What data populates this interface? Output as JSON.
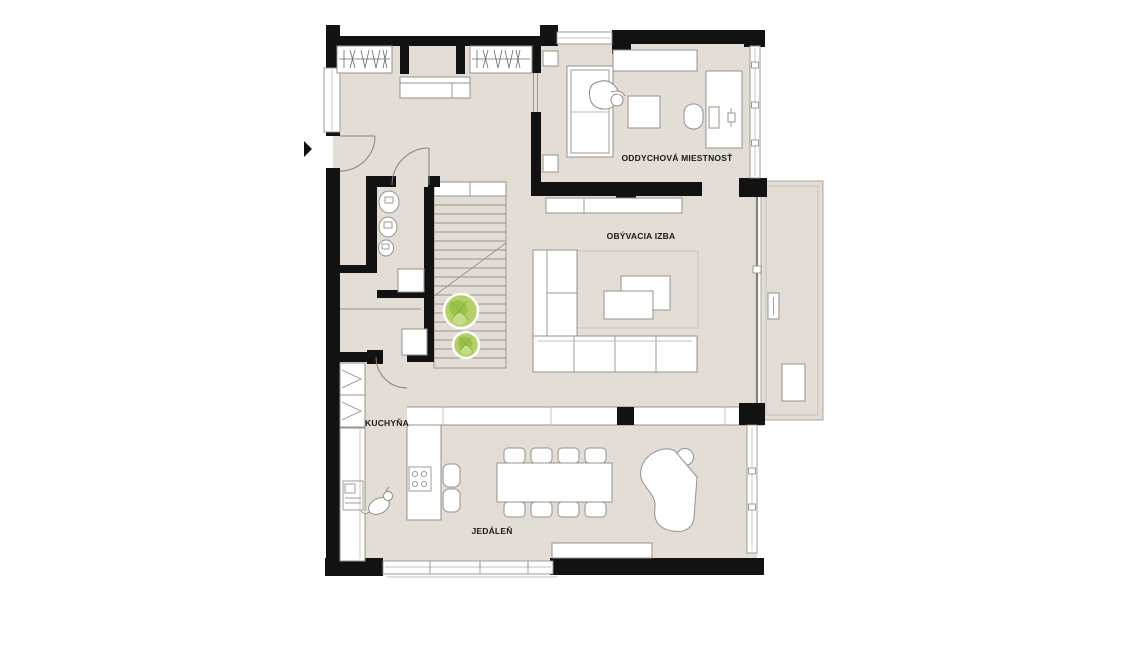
{
  "canvas": {
    "width": 1125,
    "height": 645,
    "background": "#ffffff"
  },
  "plan": {
    "type": "apartment-floor-plan",
    "rooms": [
      {
        "id": "rest-room",
        "label": "ODDYCHOVÁ MIESTNOSŤ"
      },
      {
        "id": "living-room",
        "label": "OBÝVACIA IZBA"
      },
      {
        "id": "kitchen",
        "label": "KUCHYŇA"
      },
      {
        "id": "dining-room",
        "label": "JEDÁLEŇ"
      }
    ],
    "colors": {
      "wall": "#121212",
      "floor": "#e3ddd6",
      "furniture_fill": "#ffffff",
      "furniture_stroke": "#97918b",
      "plant_green": "#b3d168",
      "plant_green_dark": "#9cc24a",
      "plant_green_light": "#c6dd8a",
      "label_text": "#1a1a1a"
    },
    "elements": [
      "entry-arrow",
      "entry-door",
      "interior-door",
      "wardrobe",
      "dresser",
      "bed",
      "person-figure",
      "nightstand",
      "ottoman",
      "desk",
      "desk-chair",
      "monitor",
      "keyboard",
      "toilet",
      "bidet",
      "washbasin",
      "washing-machine",
      "staircase",
      "plant",
      "storage-box",
      "tall-cabinet",
      "kitchen-counter",
      "sink",
      "kitchen-island",
      "cooktop",
      "bar-stool",
      "dog-figure",
      "dining-table",
      "dining-chair",
      "grand-piano",
      "piano-stool",
      "sideboard",
      "sofa",
      "coffee-table",
      "rug",
      "tv-sideboard",
      "terrace",
      "planter",
      "terrace-bench",
      "window",
      "glass-wall"
    ]
  }
}
